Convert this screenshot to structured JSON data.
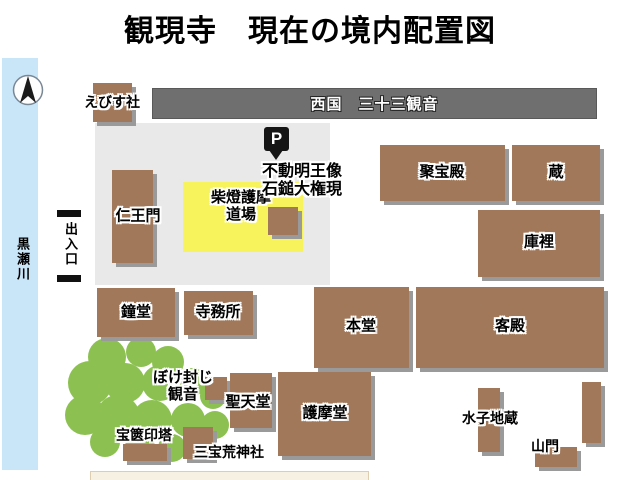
{
  "title": "観現寺　現在の境内配置図",
  "colors": {
    "brown": "#a1795a",
    "brown_shadow": "#9a9a9a",
    "gray_bar": "#6f6f6f",
    "yellow": "#f7f35c",
    "green": "#8cc152",
    "river": "#c9e5f8",
    "parking": "#e9e9e9",
    "marker": "#151515",
    "cream": "#f7f1e4"
  },
  "map": {
    "river": "黒瀬川",
    "entrance": "出入口",
    "parking_mark": "P",
    "kannon_row": "西国　三十三観音",
    "buildings": {
      "ebisusha": "えびす社",
      "niomon": "仁王門",
      "dojo_line1": "柴燈護摩",
      "dojo_line2": "道場",
      "fudo_line1": "不動明王像",
      "fudo_line2": "石鎚大権現",
      "shuhoden": "聚宝殿",
      "kura": "蔵",
      "kuri": "庫裡",
      "shodo": "鐘堂",
      "jimusho": "寺務所",
      "hondo": "本堂",
      "kyakuden": "客殿",
      "boke_line1": "ぼけ封じ",
      "boke_line2": "観音",
      "shotendo": "聖天堂",
      "gomado": "護摩堂",
      "mizuko": "水子地蔵",
      "sanmon": "山門",
      "hokyointo": "宝篋印塔",
      "sanpo": "三宝荒神社"
    }
  }
}
